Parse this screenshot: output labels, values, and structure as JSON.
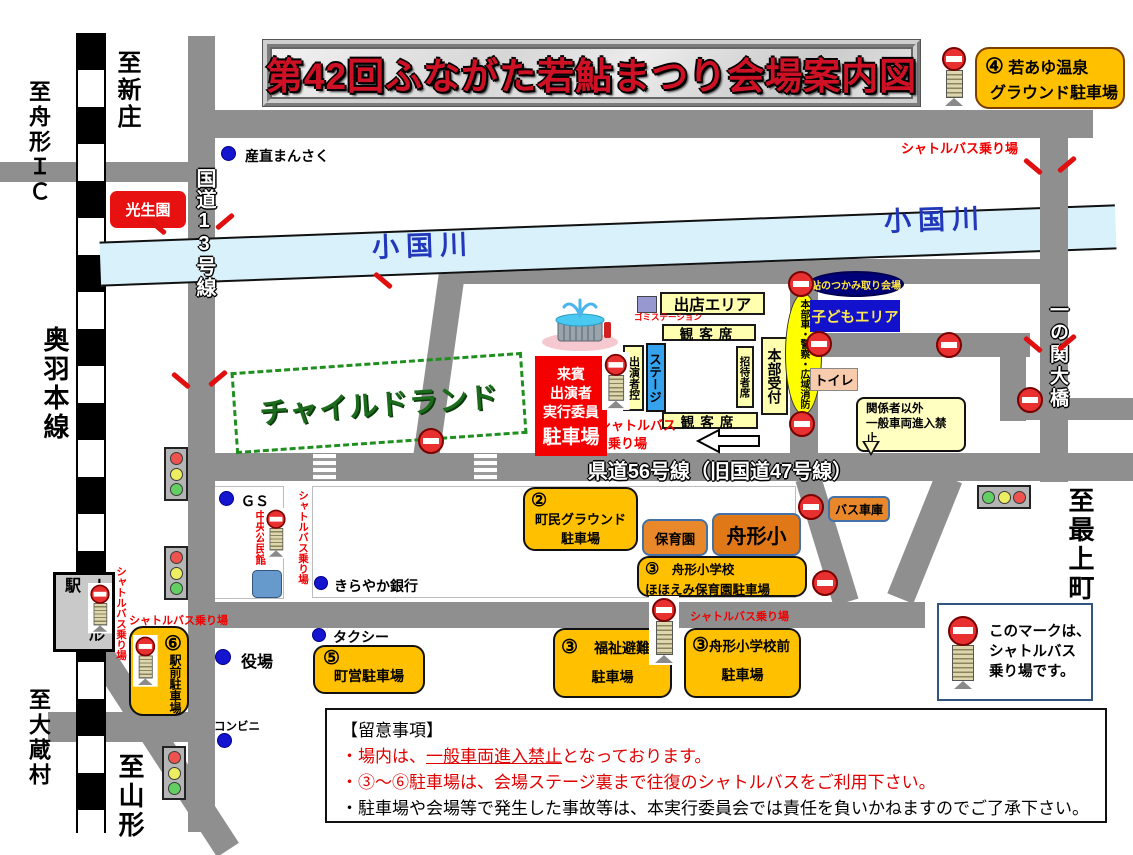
{
  "title": "第42回ふながた若鮎まつり会場案内図",
  "roads": {
    "route13": "国道13号線",
    "kendo56": "県道56号線（旧国道47号線）",
    "ichinoseki_bridge": "一の関大橋",
    "river": "小国川"
  },
  "directions": {
    "shinjo": "至新庄",
    "funagata_ic": "至舟形ＩＣ",
    "ou_line": "奥羽本線",
    "okura": "至大蔵村",
    "yamagata": "至山形",
    "mogami": "至最上町",
    "jr_station": "ＪＲ舟形駅"
  },
  "shuttle": {
    "label": "シャトルバス乗り場",
    "line1": "シャトルバス",
    "line2": "乗り場"
  },
  "legend": {
    "line1": "このマークは、",
    "line2": "シャトルバス",
    "line3": "乗り場です。"
  },
  "pois": {
    "sanchoku": "産直まんさく",
    "koseien": "光生園",
    "childland": "チャイルドランド",
    "gs": "ＧＳ",
    "kominkan": "中央公民館",
    "kirayaka": "きらやか銀行",
    "taxi": "タクシー",
    "yakuba": "役場",
    "conbini": "コンビニ",
    "bus_garage": "バス車庫",
    "hoikuen": "保育園",
    "funagata_sho": "舟形小"
  },
  "venue": {
    "shutten": "出店エリア",
    "gomi": "ゴミステーション",
    "kankyaku": "観客席",
    "stage": "ステージ",
    "shutsuensha": "出演者控",
    "shotai": "招待者席",
    "honbu": "本部受付",
    "honbu_cars": "本部車・警察・広域消防",
    "ayu": "鮎のつかみ取り会場",
    "kodomo": "子どもエリア",
    "toilet": "トイレ",
    "restrict1": "関係者以外",
    "restrict2": "一般車両進入禁止",
    "vip1": "来賓",
    "vip2": "出演者",
    "vip3": "実行委員",
    "vip4": "駐車場"
  },
  "parkings": {
    "p2num": "②",
    "p2a": "町民グラウンド",
    "p2b": "駐車場",
    "p3num": "③",
    "p3a1": "舟形小学校",
    "p3a2": "ほほえみ保育園駐車場",
    "p3b1": "福祉避難所",
    "p3b2": "駐車場",
    "p3c1": "舟形小学校前",
    "p3c2": "駐車場",
    "p4num": "④",
    "p4a": "若あゆ温泉",
    "p4b": "グラウンド駐車場",
    "p5num": "⑤",
    "p5a": "町営駐車場",
    "p6num": "⑥",
    "p6a": "駅前駐車場"
  },
  "notes": {
    "heading": "【留意事項】",
    "l1a": "・場内は、",
    "l1b": "一般車両進入禁止",
    "l1c": "となっております。",
    "l2": "・③～⑥駐車場は、会場ステージ裏まで往復のシャトルバスをご利用下さい。",
    "l3": "・駐車場や会場等で発生した事故等は、本実行委員会では責任を負いかねますのでご了承下さい。"
  },
  "colors": {
    "road": "#8f8f8f",
    "river": "#d9f1fb",
    "parking": "#ffc000",
    "venue_yellow": "#ffffb0",
    "alert_red": "#f00000"
  }
}
